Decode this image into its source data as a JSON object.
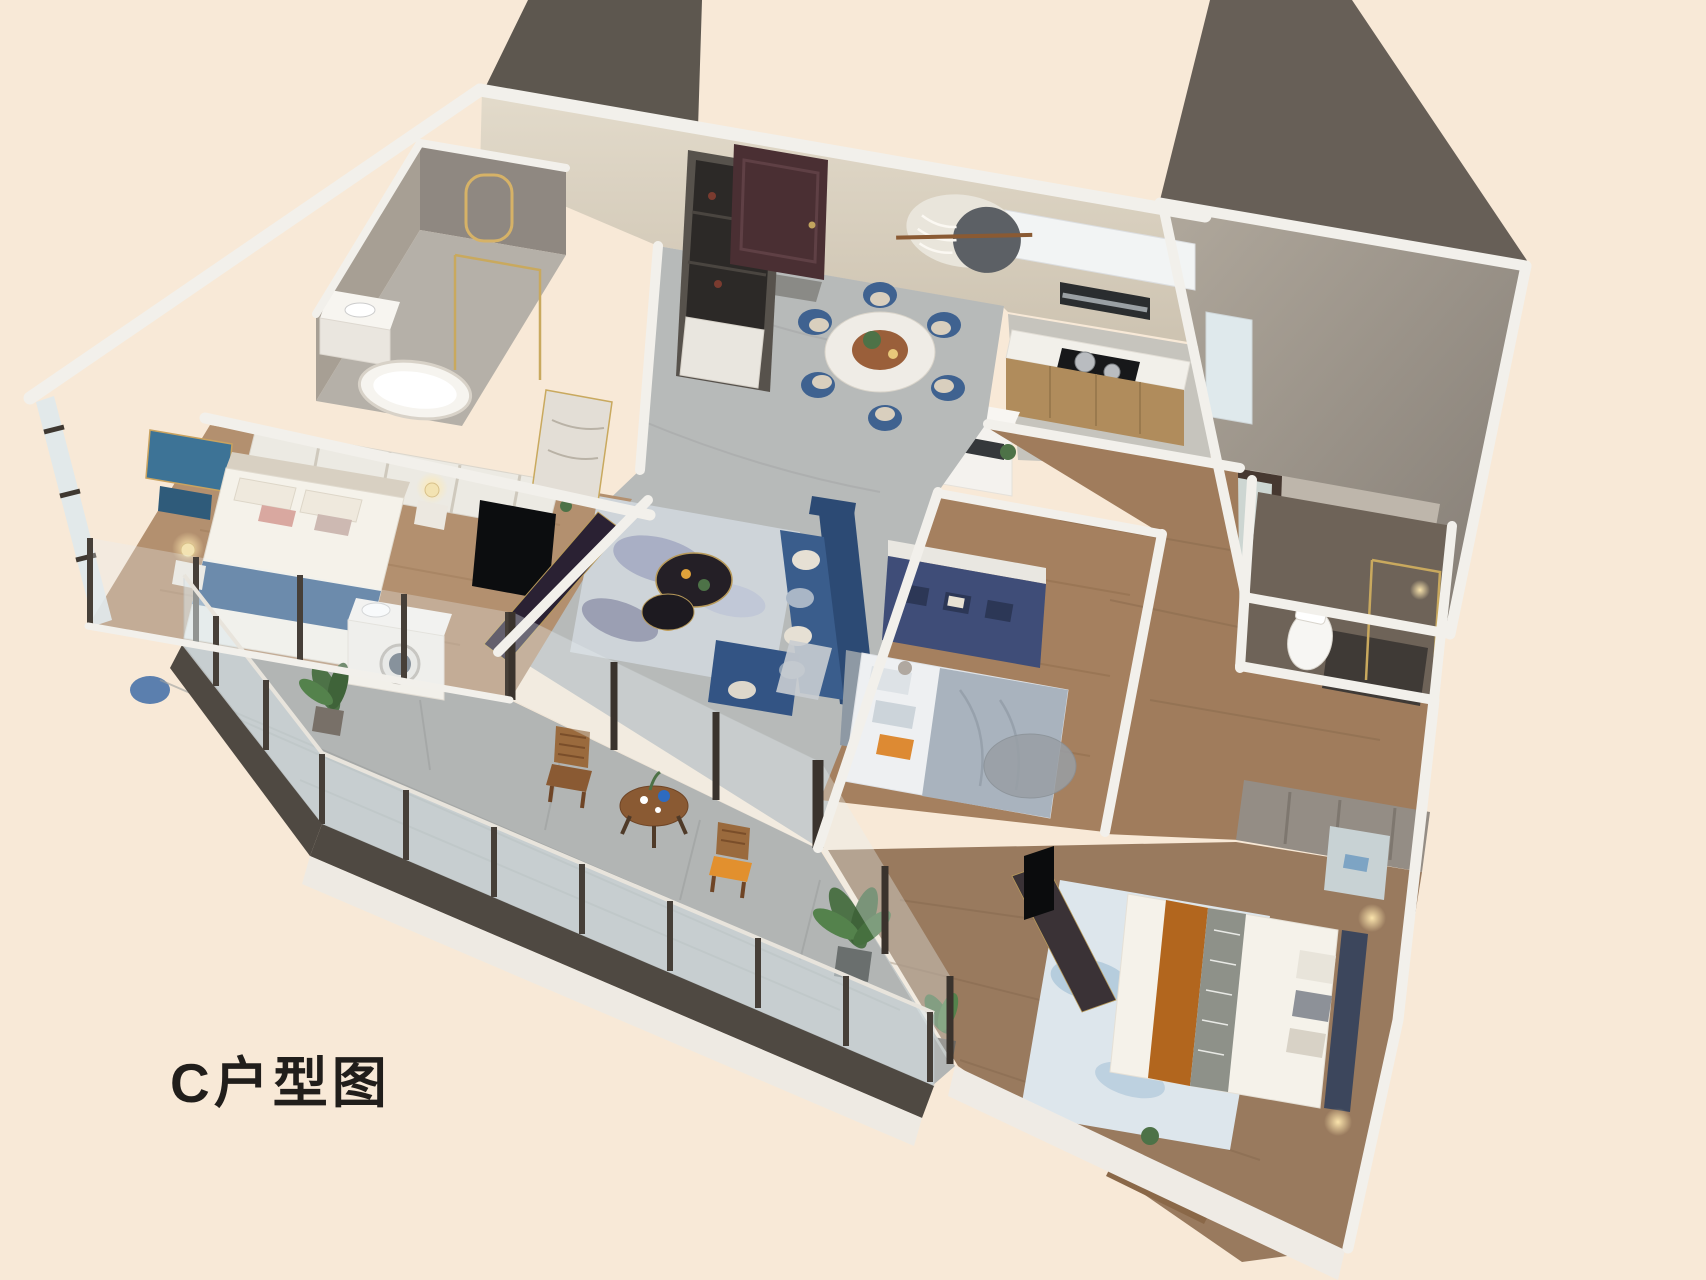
{
  "page": {
    "title_label": "C户型图"
  },
  "colors": {
    "background": "#f8e9d7",
    "text": "#211e1b",
    "wall_white": "#f2f0eb",
    "wall_shade": "#d8d2c8",
    "wall_face": "#d9d1c2",
    "dark_slab": "#5d574f",
    "gray_wall": "#8f8881",
    "tile_floor": "#b7bab9",
    "wood_floor": "#a07c5c",
    "wood_floor_light": "#b3906f",
    "balcony_floor": "#b2b5b4",
    "rug_living": "#ced4d9",
    "rug_violet": "#8b90b4",
    "rug_bed3": "#dde6ec",
    "sofa_blue": "#3a5d8c",
    "chair_blue": "#3f6290",
    "navy_cabinet": "#3f4d78",
    "bed_white": "#f5f2ea",
    "runner_blue": "#37618e",
    "runner_orange": "#b2661e",
    "pillow_orange": "#dd8a33",
    "duvet_gray": "#a9b3be",
    "door_brown": "#4a2f33",
    "tv_dark": "#2a2133",
    "bath_dark": "#6e6358",
    "gold": "#c2a45e",
    "glass": "#dfe9ec",
    "plant": "#4d7247",
    "wood_chair": "#8a5a33"
  },
  "rooms": [
    {
      "name": "ensuite-bathroom"
    },
    {
      "name": "master-bedroom"
    },
    {
      "name": "dining-area"
    },
    {
      "name": "kitchen"
    },
    {
      "name": "multipurpose-room"
    },
    {
      "name": "living-room"
    },
    {
      "name": "kids-bedroom"
    },
    {
      "name": "hallway"
    },
    {
      "name": "second-bathroom"
    },
    {
      "name": "guest-bedroom"
    },
    {
      "name": "balcony"
    }
  ]
}
